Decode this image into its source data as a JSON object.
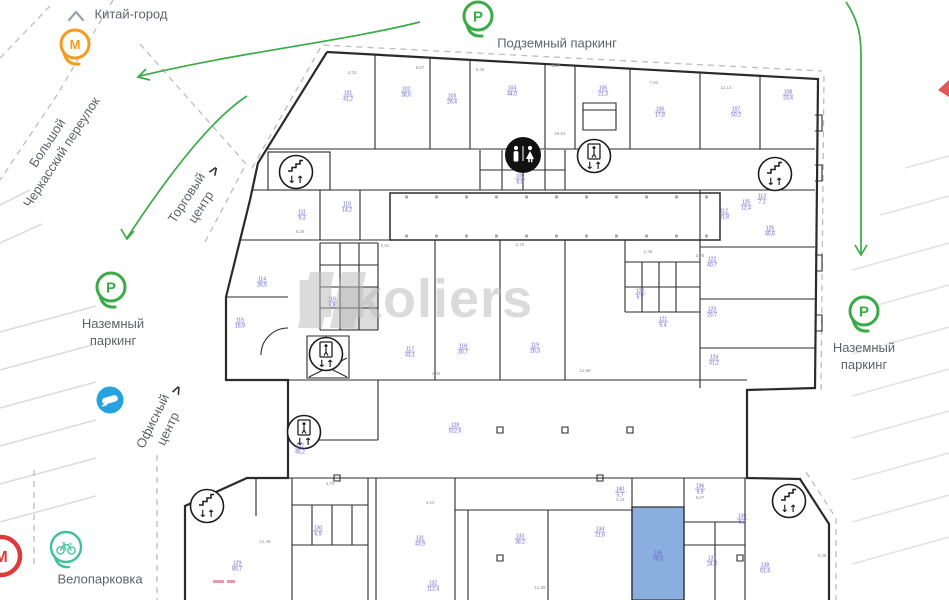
{
  "map": {
    "metro_station": {
      "letter": "М",
      "label": "Китай-город"
    },
    "street": {
      "line1": "Большой",
      "line2": "Черкасский переулок"
    },
    "underground_parking": {
      "letter": "P",
      "label": "Подземный паркинг"
    },
    "ground_parking_left": {
      "letter": "P",
      "line1": "Наземный",
      "line2": "паркинг"
    },
    "ground_parking_right": {
      "letter": "P",
      "line1": "Наземный",
      "line2": "паркинг"
    },
    "shopping_center": {
      "line1": "Торговый",
      "line2": "центр",
      "chevron": ">"
    },
    "office_center": {
      "line1": "Офисный",
      "line2": "центр",
      "chevron": ">"
    },
    "bike_parking": {
      "label": "Велопарковка"
    },
    "metro_station_bottom": {
      "letter": "М"
    }
  },
  "watermark": {
    "text": "Nikoliers"
  },
  "plan": {
    "icons": {
      "updown": "↓↑"
    },
    "rooms": [
      {
        "x": 348,
        "y": 96,
        "n": "101",
        "a": "41,2"
      },
      {
        "x": 406,
        "y": 92,
        "n": "102",
        "a": "38,6"
      },
      {
        "x": 452,
        "y": 99,
        "n": "103",
        "a": "29,4"
      },
      {
        "x": 512,
        "y": 91,
        "n": "104",
        "a": "44,0"
      },
      {
        "x": 603,
        "y": 91,
        "n": "105",
        "a": "21,3"
      },
      {
        "x": 660,
        "y": 112,
        "n": "106",
        "a": "17,8"
      },
      {
        "x": 736,
        "y": 112,
        "n": "107",
        "a": "50,2"
      },
      {
        "x": 788,
        "y": 95,
        "n": "108",
        "a": "23,4"
      },
      {
        "x": 520,
        "y": 179,
        "n": "109",
        "a": "8,6"
      },
      {
        "x": 347,
        "y": 207,
        "n": "110",
        "a": "14,2"
      },
      {
        "x": 302,
        "y": 215,
        "n": "111",
        "a": "9,3"
      },
      {
        "x": 724,
        "y": 214,
        "n": "112",
        "a": "31,8"
      },
      {
        "x": 762,
        "y": 199,
        "n": "113",
        "a": "7,1"
      },
      {
        "x": 262,
        "y": 282,
        "n": "114",
        "a": "26,5"
      },
      {
        "x": 240,
        "y": 323,
        "n": "115",
        "a": "18,9"
      },
      {
        "x": 332,
        "y": 302,
        "n": "116",
        "a": "4,8"
      },
      {
        "x": 410,
        "y": 352,
        "n": "117",
        "a": "33,1"
      },
      {
        "x": 463,
        "y": 349,
        "n": "118",
        "a": "30,7"
      },
      {
        "x": 535,
        "y": 348,
        "n": "119",
        "a": "28,3"
      },
      {
        "x": 640,
        "y": 294,
        "n": "120",
        "a": "6,2"
      },
      {
        "x": 663,
        "y": 322,
        "n": "121",
        "a": "5,4"
      },
      {
        "x": 712,
        "y": 262,
        "n": "122",
        "a": "40,7"
      },
      {
        "x": 712,
        "y": 312,
        "n": "123",
        "a": "29,7"
      },
      {
        "x": 714,
        "y": 360,
        "n": "124",
        "a": "31,2"
      },
      {
        "x": 746,
        "y": 205,
        "n": "125",
        "a": "12,4"
      },
      {
        "x": 770,
        "y": 231,
        "n": "126",
        "a": "45,6"
      },
      {
        "x": 300,
        "y": 449,
        "n": "127",
        "a": "46,2"
      },
      {
        "x": 455,
        "y": 428,
        "n": "128",
        "a": "512,6"
      },
      {
        "x": 237,
        "y": 566,
        "n": "129",
        "a": "80,7"
      },
      {
        "x": 318,
        "y": 531,
        "n": "130",
        "a": "6,9"
      },
      {
        "x": 420,
        "y": 541,
        "n": "131",
        "a": "43,9"
      },
      {
        "x": 433,
        "y": 586,
        "n": "132",
        "a": "112,4"
      },
      {
        "x": 520,
        "y": 539,
        "n": "133",
        "a": "38,2"
      },
      {
        "x": 600,
        "y": 532,
        "n": "134",
        "a": "21,6"
      },
      {
        "x": 658,
        "y": 556,
        "n": "135",
        "a": "56,8"
      },
      {
        "x": 700,
        "y": 489,
        "n": "136",
        "a": "9,9"
      },
      {
        "x": 712,
        "y": 561,
        "n": "137",
        "a": "24,3"
      },
      {
        "x": 765,
        "y": 568,
        "n": "138",
        "a": "61,4"
      },
      {
        "x": 742,
        "y": 519,
        "n": "139",
        "a": "8,2"
      },
      {
        "x": 620,
        "y": 492,
        "n": "140",
        "a": "5,7"
      }
    ],
    "dims": [
      {
        "x": 352,
        "y": 73,
        "t": "4,33"
      },
      {
        "x": 420,
        "y": 68,
        "t": "5,07"
      },
      {
        "x": 480,
        "y": 70,
        "t": "5,45"
      },
      {
        "x": 556,
        "y": 66,
        "t": "3,27"
      },
      {
        "x": 654,
        "y": 83,
        "t": "7,64"
      },
      {
        "x": 726,
        "y": 88,
        "t": "11,13"
      },
      {
        "x": 560,
        "y": 134,
        "t": "28,01"
      },
      {
        "x": 300,
        "y": 232,
        "t": "6,29"
      },
      {
        "x": 385,
        "y": 246,
        "t": "2,91"
      },
      {
        "x": 520,
        "y": 245,
        "t": "2,76"
      },
      {
        "x": 648,
        "y": 252,
        "t": "1,46"
      },
      {
        "x": 700,
        "y": 256,
        "t": "3,25"
      },
      {
        "x": 436,
        "y": 374,
        "t": "4,34"
      },
      {
        "x": 585,
        "y": 371,
        "t": "11,68"
      },
      {
        "x": 330,
        "y": 484,
        "t": "4,70"
      },
      {
        "x": 430,
        "y": 503,
        "t": "4,23"
      },
      {
        "x": 620,
        "y": 500,
        "t": "4,33"
      },
      {
        "x": 700,
        "y": 498,
        "t": "5,07"
      },
      {
        "x": 265,
        "y": 542,
        "t": "11,48"
      },
      {
        "x": 540,
        "y": 588,
        "t": "11,88"
      },
      {
        "x": 822,
        "y": 556,
        "t": "3,48"
      }
    ]
  },
  "colors": {
    "green": "#3aab47",
    "orange": "#f59b1e",
    "teal": "#41c19b",
    "blue_sign": "#25a3e1",
    "red": "#dd3a3a",
    "room_label": "#6a5fd0",
    "highlight": "#7ba3d9",
    "wall": "#2b2b2b",
    "muted_text": "#5f6368"
  }
}
